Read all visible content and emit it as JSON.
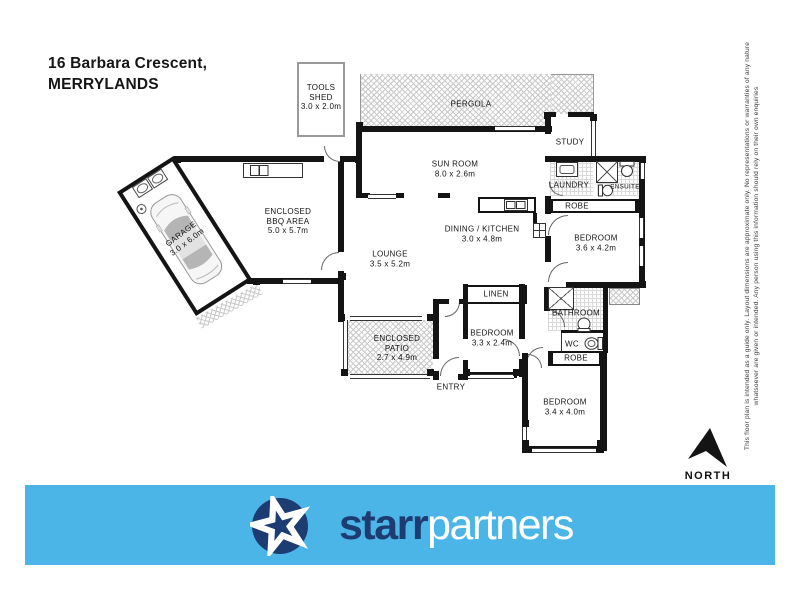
{
  "title": {
    "line1": "16 Barbara Crescent,",
    "line2": "MERRYLANDS"
  },
  "rooms": {
    "tools_shed": {
      "l1": "TOOLS",
      "l2": "SHED",
      "l3": "3.0 x 2.0m"
    },
    "pergola": {
      "l1": "PERGOLA"
    },
    "sun_room": {
      "l1": "SUN ROOM",
      "l2": "8.0 x 2.6m"
    },
    "study": {
      "l1": "STUDY"
    },
    "laundry": {
      "l1": "LAUNDRY"
    },
    "ensuite": {
      "l1": "ENSUITE"
    },
    "robe_top": {
      "l1": "ROBE"
    },
    "bedroom_rear": {
      "l1": "BEDROOM",
      "l2": "3.6 x 4.2m"
    },
    "dining_kitchen": {
      "l1": "DINING / KITCHEN",
      "l2": "3.0 x 4.8m"
    },
    "lounge": {
      "l1": "LOUNGE",
      "l2": "3.5 x 5.2m"
    },
    "bbq": {
      "l1": "ENCLOSED",
      "l2": "BBQ AREA",
      "l3": "5.0 x 5.7m"
    },
    "garage": {
      "l1": "GARAGE",
      "l2": "3.0 x 6.0m"
    },
    "linen": {
      "l1": "LINEN"
    },
    "bedroom_mid": {
      "l1": "BEDROOM",
      "l2": "3.3 x 2.4m"
    },
    "patio": {
      "l1": "ENCLOSED",
      "l2": "PATIO",
      "l3": "2.7 x 4.9m"
    },
    "entry": {
      "l1": "ENTRY"
    },
    "bathroom": {
      "l1": "BATHROOM"
    },
    "wc": {
      "l1": "WC"
    },
    "robe_bottom": {
      "l1": "ROBE"
    },
    "bedroom_front": {
      "l1": "BEDROOM",
      "l2": "3.4 x 4.0m"
    }
  },
  "compass": {
    "label": "NORTH"
  },
  "disclaimer": {
    "line1": "This floor plan is intended as a guide only. Layout dimensions are approximate only. No representations or warranties of any nature",
    "line2": "whatsoever are given or intended. Any person using this information should rely on their own enquiries"
  },
  "footer": {
    "brand_bold": "starr",
    "brand_light": "partners"
  },
  "colors": {
    "banner_blue": "#4cb5e8",
    "brand_navy": "#1c3c72"
  }
}
